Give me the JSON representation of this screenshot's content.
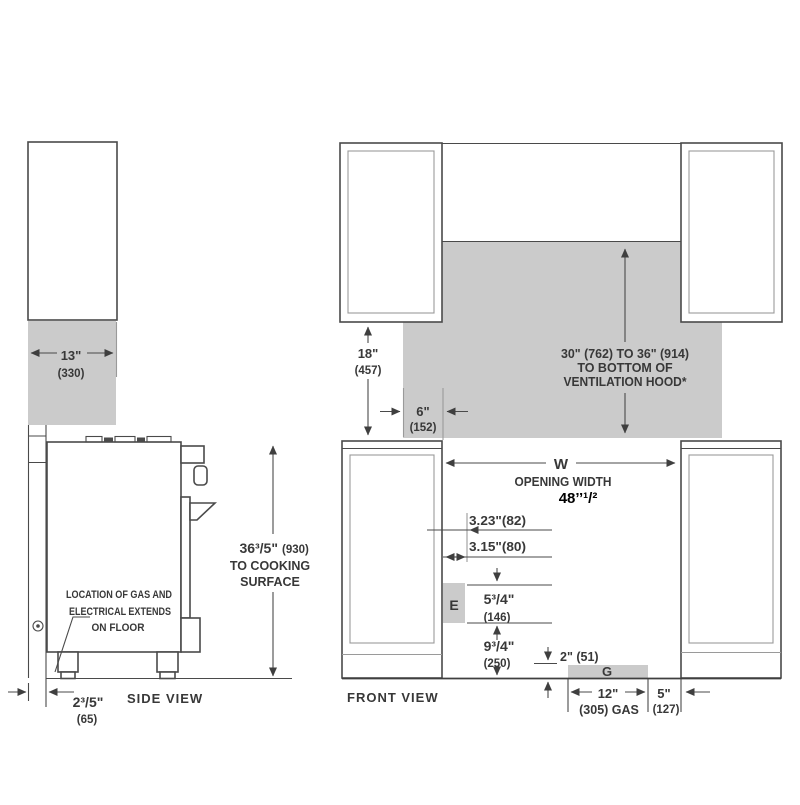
{
  "colors": {
    "gray_fill": "#cbcbcb",
    "line": "#4a4a4a",
    "line_light": "#9a9a9a",
    "text": "#383838",
    "annotation": "#000000"
  },
  "side_view": {
    "label": "SIDE VIEW",
    "cabinet_depth_in": "13\"",
    "cabinet_depth_mm": "(330)",
    "height_in": "36³/5\"",
    "height_mm": "(930)",
    "height_note_line1": "TO COOKING",
    "height_note_line2": "SURFACE",
    "gas_note_line1": "LOCATION OF GAS AND",
    "gas_note_line2": "ELECTRICAL EXTENDS",
    "gas_note_line3": "ON FLOOR",
    "wall_gap_in": "2³/5\"",
    "wall_gap_mm": "(65)"
  },
  "front_view": {
    "label": "FRONT VIEW",
    "hood_clearance_in": "18\"",
    "hood_clearance_mm": "(457)",
    "hood_height_line1": "30\" (762) TO 36\" (914)",
    "hood_height_line2": "TO BOTTOM OF",
    "hood_height_line3": "VENTILATION HOOD*",
    "hood_overhang_in": "6\"",
    "hood_overhang_mm": "(152)",
    "opening_symbol": "W",
    "opening_label": "OPENING WIDTH",
    "opening_value": "48’’¹/²",
    "electrical_offset_a": "3.23\"(82)",
    "electrical_offset_b": "3.15\"(80)",
    "electrical_symbol": "E",
    "electrical_height_in": "5³/4\"",
    "electrical_height_mm": "(146)",
    "electrical_floor_in": "9³/4\"",
    "electrical_floor_mm": "(250)",
    "gas_height": "2\" (51)",
    "gas_symbol": "G",
    "gas_width_in": "12\"",
    "gas_width_mm": "(305) GAS",
    "gas_side_in": "5\"",
    "gas_side_mm": "(127)"
  }
}
